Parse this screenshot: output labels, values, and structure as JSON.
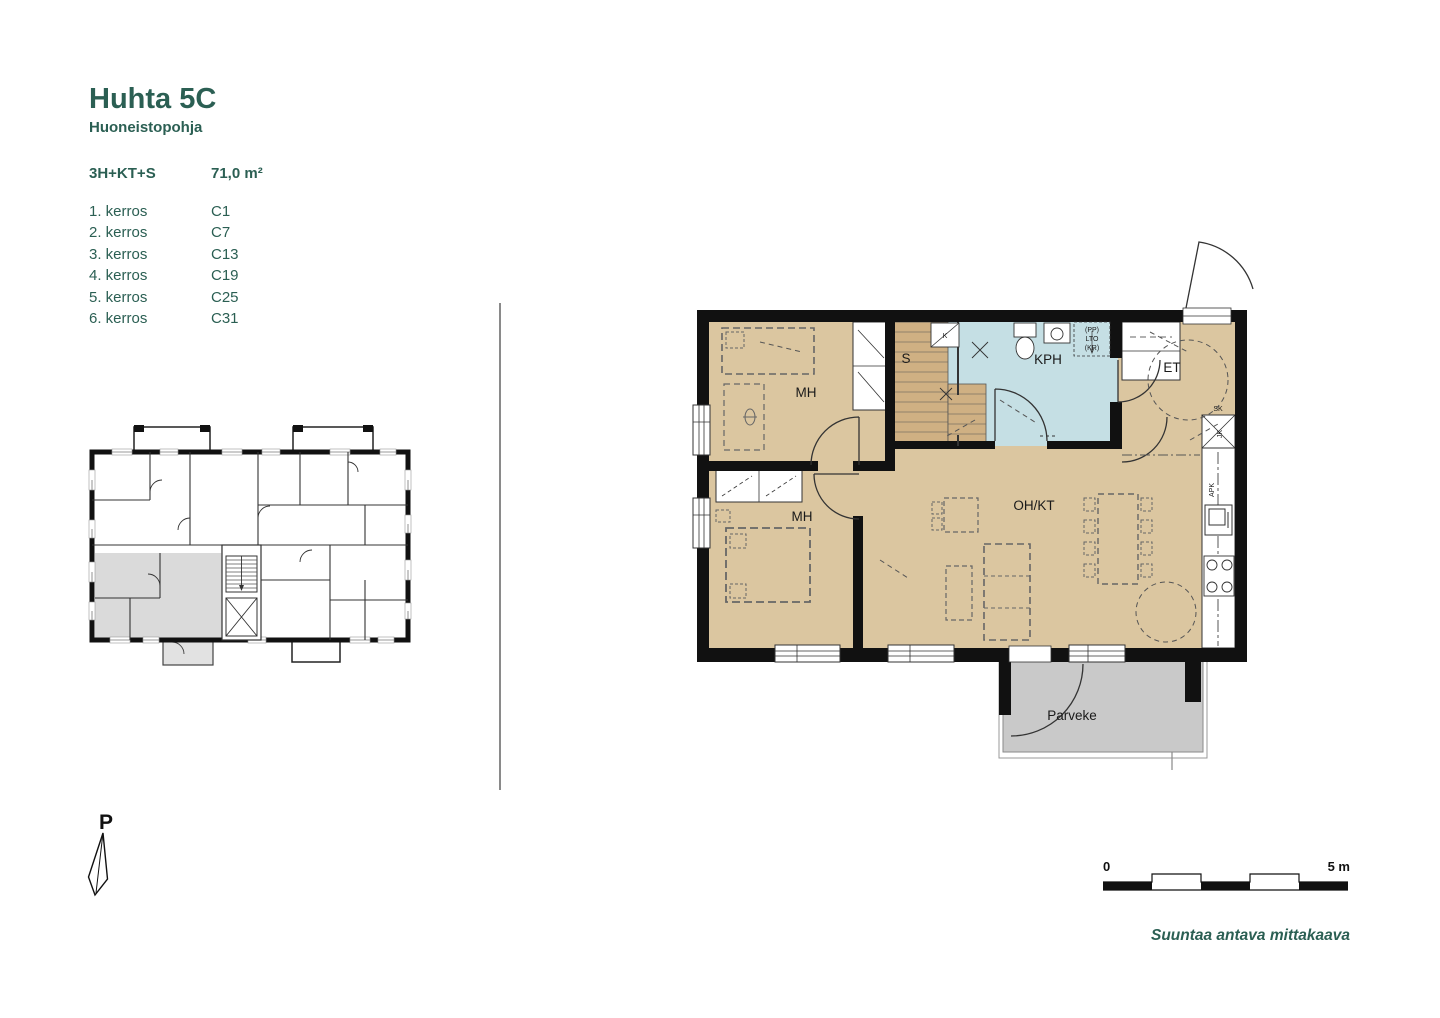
{
  "header": {
    "title": "Huhta 5C",
    "subtitle": "Huoneistopohja"
  },
  "apartment": {
    "type": "3H+KT+S",
    "area": "71,0 m²"
  },
  "floors_table": {
    "rows": [
      {
        "floor": "1. kerros",
        "code": "C1"
      },
      {
        "floor": "2. kerros",
        "code": "C7"
      },
      {
        "floor": "3. kerros",
        "code": "C13"
      },
      {
        "floor": "4. kerros",
        "code": "C19"
      },
      {
        "floor": "5. kerros",
        "code": "C25"
      },
      {
        "floor": "6. kerros",
        "code": "C31"
      }
    ]
  },
  "large_plan": {
    "room_labels": {
      "bedroom_top": "MH",
      "sauna": "S",
      "bathroom": "KPH",
      "entry": "ET",
      "bedroom_bottom": "MH",
      "living_kitchen": "OH/KT",
      "balcony": "Parveke"
    },
    "appliance_labels": {
      "washer": "(PP)",
      "heat_recovery": "LTO",
      "dryer": "(KR)",
      "cabinet": "K",
      "cleaning_closet": "SK",
      "fridge": "JK",
      "dishwasher": "APK"
    }
  },
  "north_arrow": {
    "label": "P"
  },
  "scale_bar": {
    "start_label": "0",
    "end_label": "5 m",
    "caption": "Suuntaa antava mittakaava"
  },
  "colors": {
    "accent_green": "#2B5F53",
    "room_beige": "#DBC6A0",
    "wet_blue": "#C5DFE4",
    "balcony_grey": "#C9C9C9",
    "highlight_grey": "#DADADA",
    "wall_black": "#111111",
    "sauna_bench": "#CFB083"
  }
}
